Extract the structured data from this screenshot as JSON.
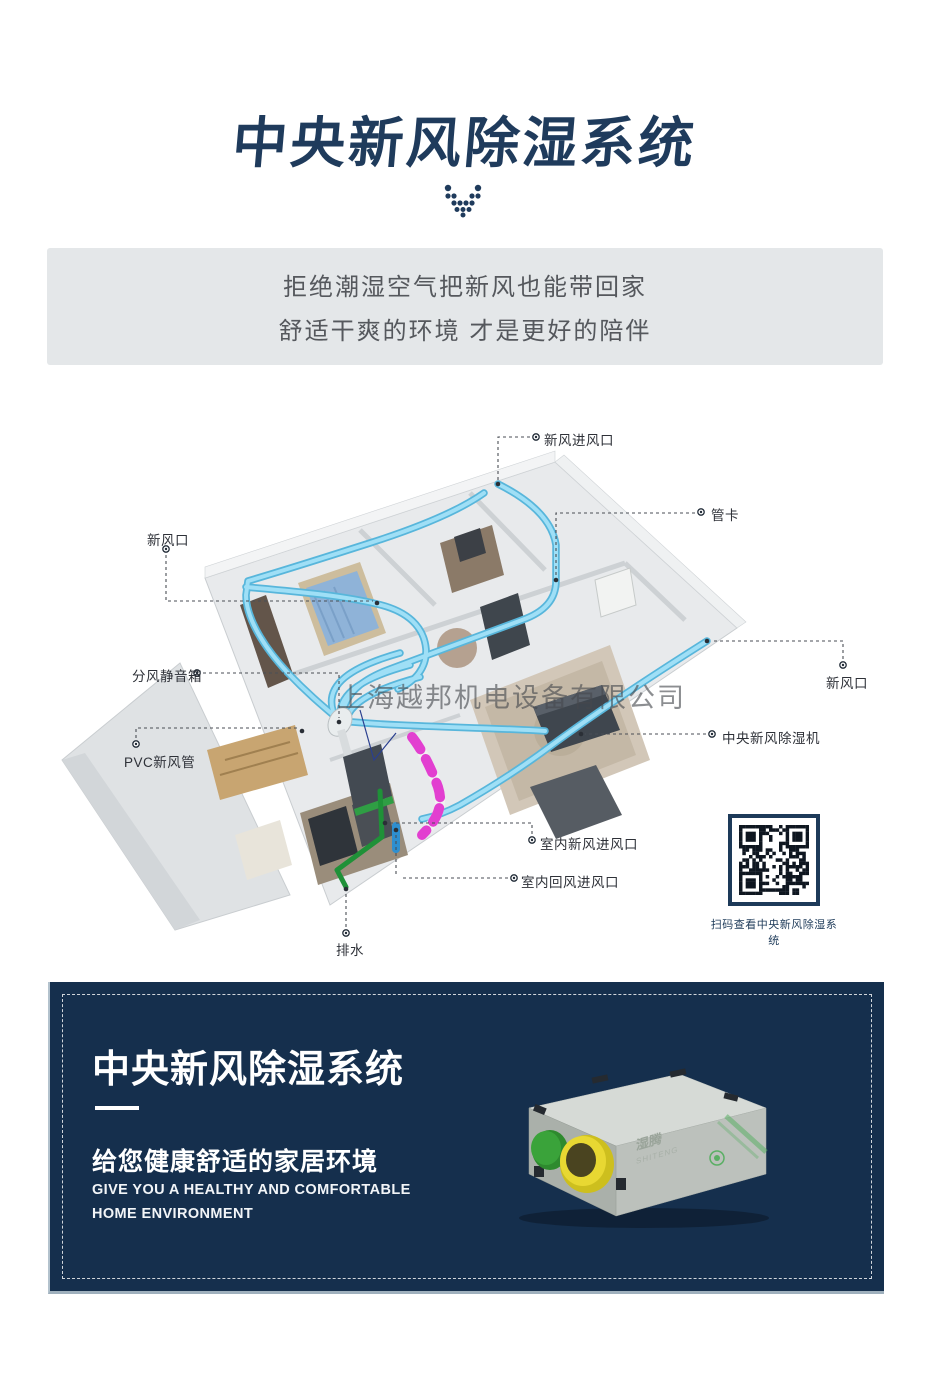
{
  "header": {
    "title": "中央新风除湿系统"
  },
  "banner": {
    "line1": "拒绝潮湿空气把新风也能带回家",
    "line2": "舒适干爽的环境 才是更好的陪伴"
  },
  "diagram": {
    "watermark": "上海越邦机电设备有限公司",
    "labels": [
      {
        "id": "fresh-air-intake",
        "text": "新风进风口"
      },
      {
        "id": "pipe-clamp",
        "text": "管卡"
      },
      {
        "id": "fresh-air-vent-left",
        "text": "新风口"
      },
      {
        "id": "air-silencer-box",
        "text": "分风静音箱"
      },
      {
        "id": "pvc-duct",
        "text": "PVC新风管"
      },
      {
        "id": "fresh-air-vent-right",
        "text": "新风口"
      },
      {
        "id": "central-unit",
        "text": "中央新风除湿机"
      },
      {
        "id": "indoor-fresh-inlet",
        "text": "室内新风进风口"
      },
      {
        "id": "indoor-return-inlet",
        "text": "室内回风进风口"
      },
      {
        "id": "drain",
        "text": "排水"
      }
    ]
  },
  "qr": {
    "caption": "扫码查看中央新风除湿系统"
  },
  "footer": {
    "title": "中央新风除湿系统",
    "subtitle": "给您健康舒适的家居环境",
    "tagline1": "GIVE YOU A HEALTHY AND COMFORTABLE",
    "tagline2": "HOME ENVIRONMENT",
    "product_brand": "湿腾",
    "product_brand_en": "SHITENG"
  },
  "colors": {
    "navy": "#1f3b5c",
    "panel_navy": "#152f4d",
    "banner_bg": "#e4e7e9",
    "pipe_blue": "#9fdff6",
    "duct_magenta": "#e23fd0",
    "drain_green": "#1f9138"
  }
}
